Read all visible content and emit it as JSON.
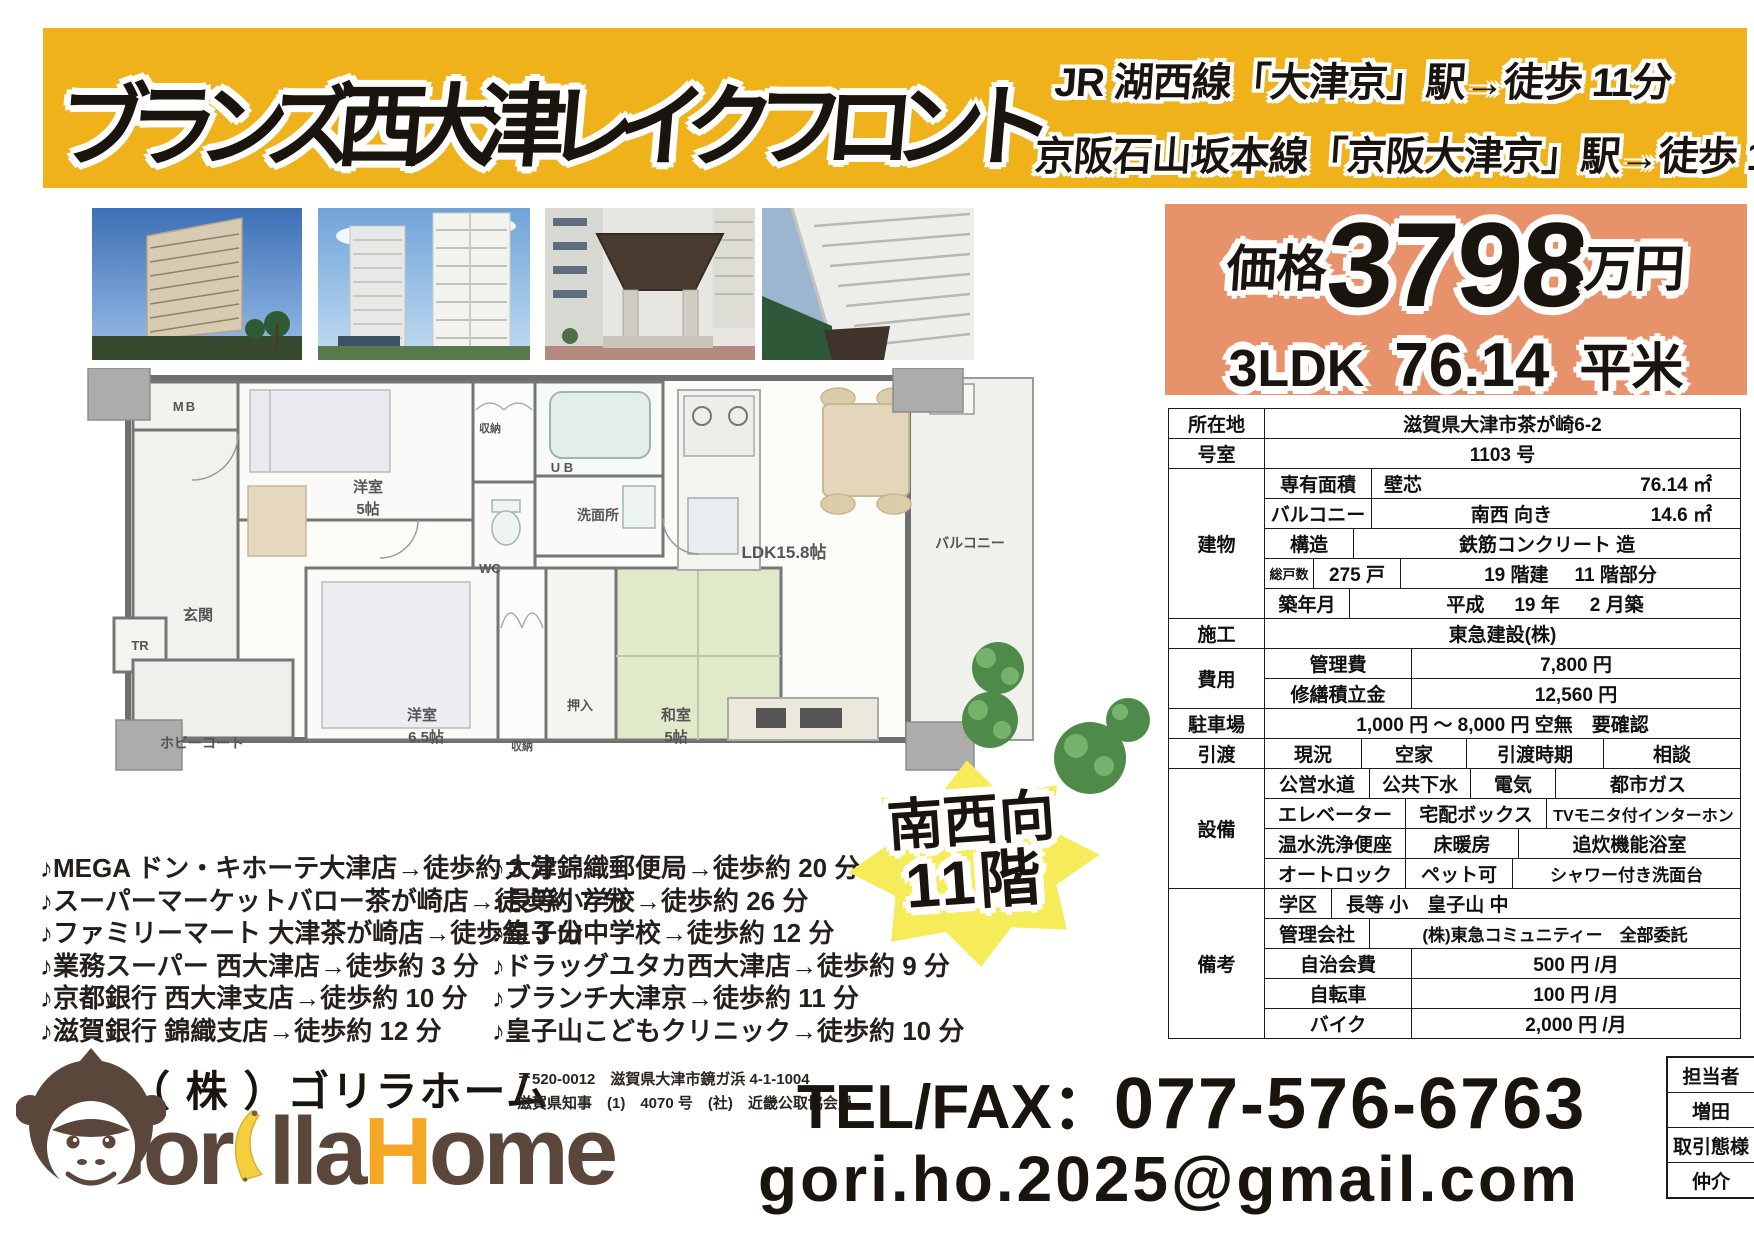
{
  "colors": {
    "banner_yellow": "#F0B21B",
    "price_salmon": "#E8926C",
    "badge_yellow": "#F6EB58",
    "brand_brown": "#5A463A",
    "brand_orange": "#F5A623",
    "tatami_green": "#E0EACA"
  },
  "header": {
    "title": "ブランズ西大津レイクフロント",
    "access1": "JR 湖西線「大津京」駅→徒歩 11分",
    "access2": "京阪石山坂本線「京阪大津京」駅→徒歩 14分"
  },
  "price": {
    "label": "価格",
    "amount": "3798",
    "unit": "万円",
    "layout": "3LDK",
    "area": "76.14",
    "area_unit": "平米"
  },
  "plan": {
    "mb": "MB",
    "bed1": "洋室",
    "bed1_size": "5帖",
    "closet1": "収納",
    "ub": "U B",
    "wash": "洗面所",
    "wc": "WC",
    "entrance": "玄関",
    "tr": "TR",
    "hobby": "ホビーコート",
    "bed2": "洋室",
    "bed2_size": "6.5帖",
    "closet2": "収納",
    "oshiire": "押入",
    "jp_room": "和室",
    "jp_size": "5帖",
    "ldk": "LDK15.8帖",
    "balcony": "バルコニー"
  },
  "table": {
    "loc_label": "所在地",
    "loc": "滋賀県大津市茶が崎6-2",
    "room_label": "号室",
    "room": "1103 号",
    "bldg_label": "建物",
    "area_label": "専有面積",
    "area_kind": "壁芯",
    "area_val": "76.14 ㎡",
    "balc_label": "バルコニー",
    "balc_dir": "南西 向き",
    "balc_val": "14.6 ㎡",
    "struct_label": "構造",
    "struct_val": "鉄筋コンクリート 造",
    "units_label": "総戸数",
    "units_val": "275 戸",
    "floors_val": "19 階建",
    "floor_part": "11 階部分",
    "built_label": "築年月",
    "built_era": "平成",
    "built_year": "19 年",
    "built_month": "2 月築",
    "const_label": "施工",
    "const_val": "東急建設(株)",
    "cost_label": "費用",
    "mgmt_label": "管理費",
    "mgmt_val": "7,800 円",
    "repair_label": "修繕積立金",
    "repair_val": "12,560 円",
    "park_label": "駐車場",
    "park_val": "1,000 円 ～ 8,000 円 空無　要確認",
    "hand_label": "引渡",
    "cond_label": "現況",
    "cond_val": "空家",
    "time_label": "引渡時期",
    "time_val": "相談",
    "equip_label": "設備",
    "equip": [
      [
        "公営水道",
        "公共下水",
        "電気",
        "都市ガス"
      ],
      [
        "エレベーター",
        "宅配ボックス",
        "TVモニタ付インターホン"
      ],
      [
        "温水洗浄便座",
        "床暖房",
        "追炊機能浴室"
      ],
      [
        "オートロック",
        "ペット可",
        "シャワー付き洗面台"
      ]
    ],
    "note_label": "備考",
    "school_label": "学区",
    "school_val": "長等 小　皇子山 中",
    "mgmtco_label": "管理会社",
    "mgmtco_val": "(株)東急コミュニティー　全部委託",
    "jichi_label": "自治会費",
    "jichi_val": "500 円 /月",
    "cycle_label": "自転車",
    "cycle_val": "100 円 /月",
    "moto_label": "バイク",
    "moto_val": "2,000 円 /月"
  },
  "nearby": {
    "left": [
      "♪MEGA ドン・キホーテ大津店→徒歩約 3 分",
      "♪スーパーマーケットバロー茶が崎店→徒歩約 7 分",
      "♪ファミリーマート 大津茶が崎店→徒歩約 3 分",
      "♪業務スーパー 西大津店→徒歩約 3 分",
      "♪京都銀行 西大津支店→徒歩約 10 分",
      "♪滋賀銀行 錦織支店→徒歩約 12 分"
    ],
    "right": [
      "♪大津錦織郵便局→徒歩約 20 分",
      "♪長等小学校→徒歩約 26 分",
      "♪皇子山中学校→徒歩約 12 分",
      "♪ドラッグユタカ西大津店→徒歩約 9 分",
      "♪ブランチ大津京→徒歩約 11 分",
      "♪皇子山こどもクリニック→徒歩約 10 分"
    ]
  },
  "badge": {
    "line1": "南西向",
    "line2": "11階"
  },
  "footer": {
    "company": "（ 株 ）ゴリラホーム",
    "wordmark_a": "Gor",
    "wordmark_b": "lla",
    "wordmark_c": "H",
    "wordmark_d": "ome",
    "postal": "〒520-0012　滋賀県大津市鏡ガ浜 4-1-1004",
    "license": "滋賀県知事　(1)　4070 号　(社)　近畿公取協会員",
    "tel_label": "TEL/FAX：",
    "tel_number": "077-576-6763",
    "email": "gori.ho.2025@gmail.com",
    "staff_label": "担当者",
    "staff_name": "増田",
    "deal_label": "取引態様",
    "deal_type": "仲介"
  }
}
